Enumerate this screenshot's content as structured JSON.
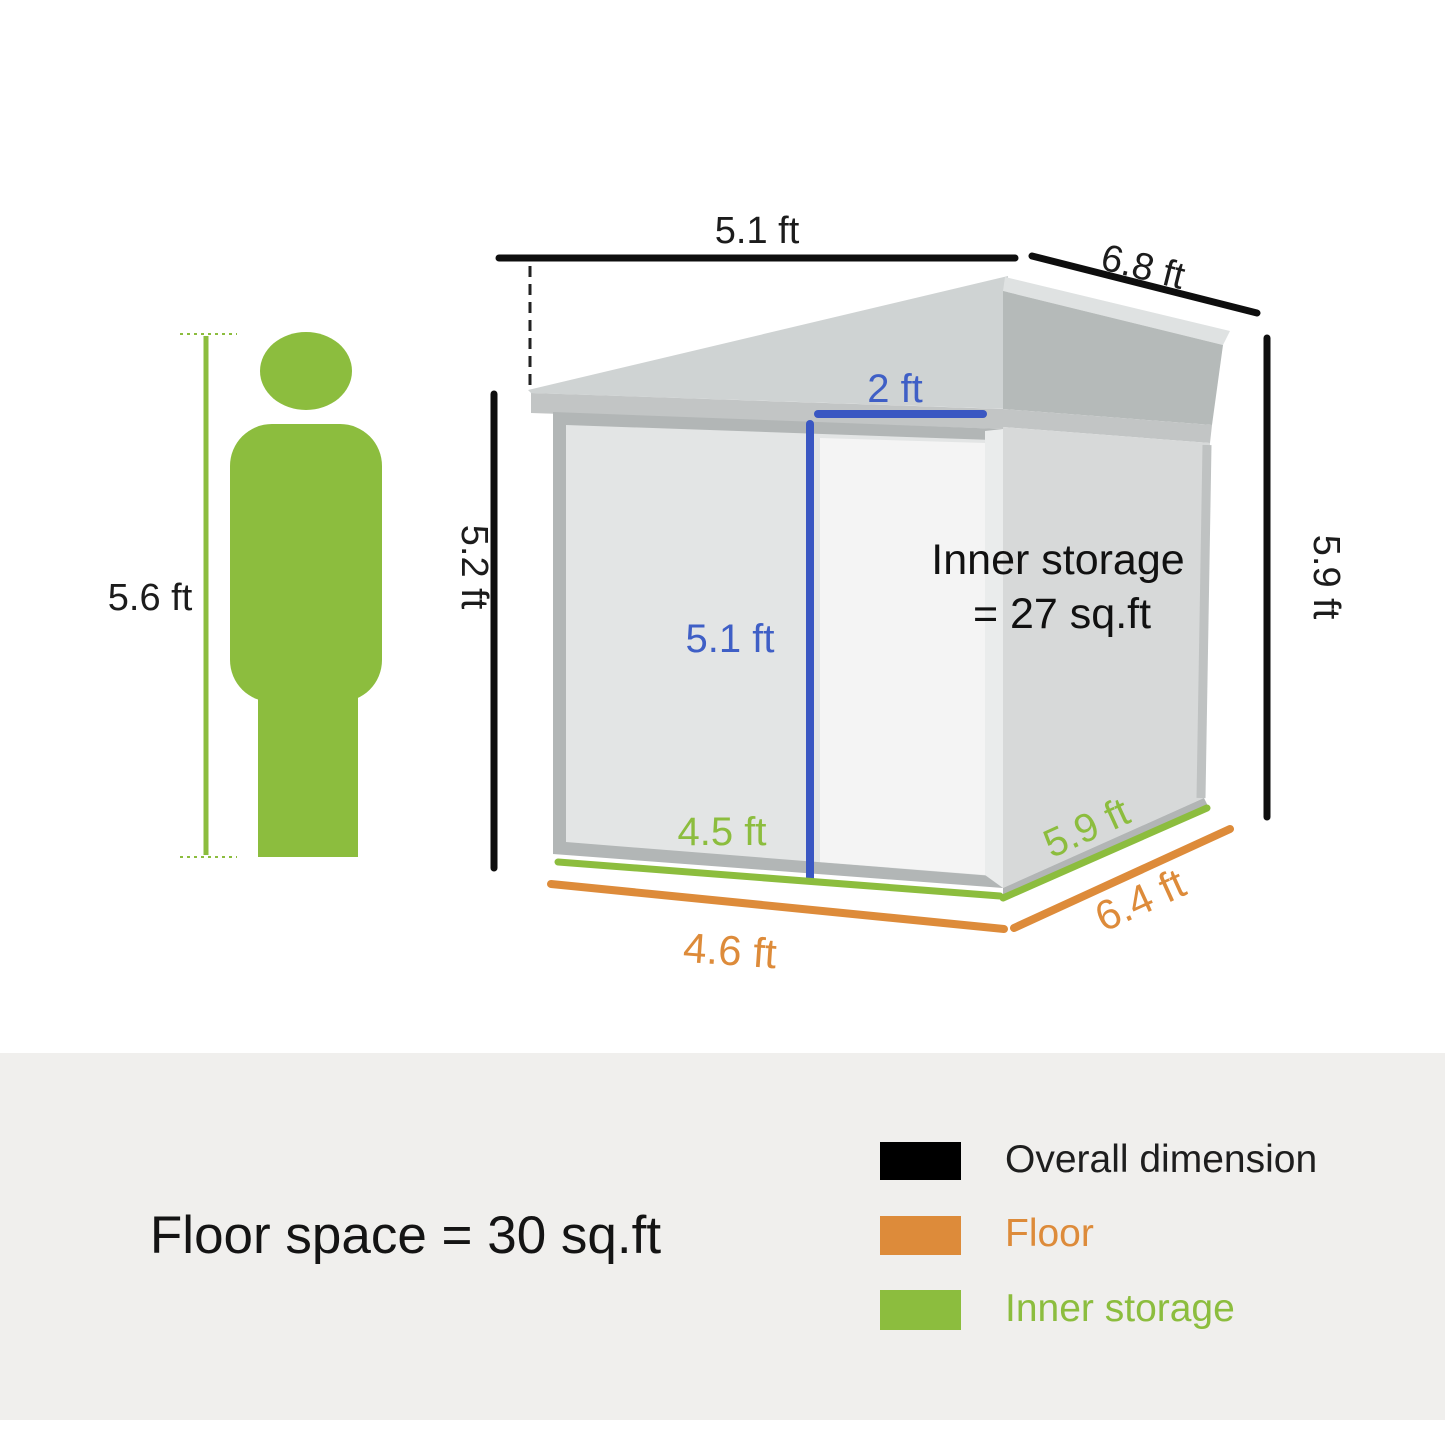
{
  "shed_diagram": {
    "person": {
      "height": "5.6 ft"
    },
    "overall": {
      "front_width": "5.1 ft",
      "depth": "6.8 ft",
      "front_height": "5.2 ft",
      "back_height": "5.9 ft"
    },
    "door": {
      "width": "2 ft",
      "height": "5.1 ft"
    },
    "inner_storage": {
      "front_width": "4.5 ft",
      "side_depth": "5.9 ft",
      "label_line1": "Inner storage",
      "label_line2": "= 27 sq.ft"
    },
    "floor": {
      "front_width": "4.6 ft",
      "side_depth": "6.4 ft"
    }
  },
  "summary": {
    "floor_space": "Floor space = 30 sq.ft"
  },
  "legend": {
    "items": [
      {
        "label": "Overall dimension",
        "color": "#000000"
      },
      {
        "label": "Floor",
        "color": "#dd8b3a"
      },
      {
        "label": "Inner storage",
        "color": "#8cbd3e"
      }
    ]
  },
  "colors": {
    "overall_dimension": "#000000",
    "floor": "#dd8b3a",
    "inner_storage": "#8cbd3e",
    "door_dimension": "#3a57c2",
    "person": "#8cbd3e",
    "panel_background": "#f0efed"
  }
}
